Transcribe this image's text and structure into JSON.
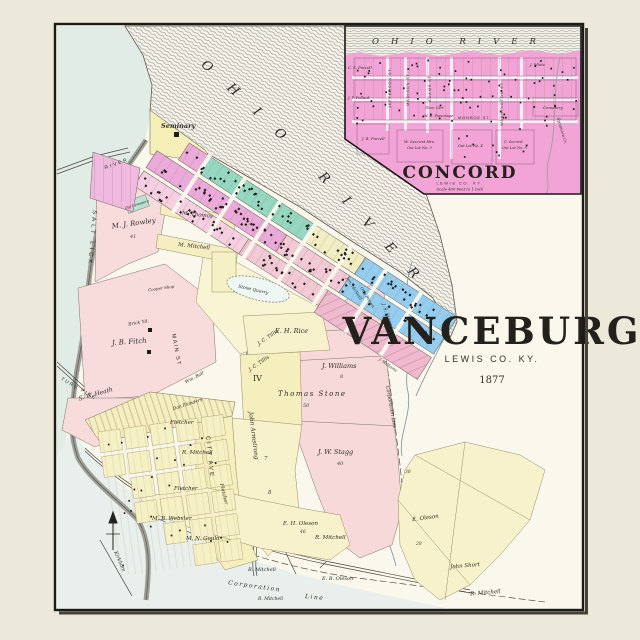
{
  "map": {
    "river_label": "OHIO RIVER",
    "title": "VANCEBURG",
    "subtitle": "LEWIS CO. KY.",
    "year": "1877",
    "labels": {
      "seminary": "Seminary",
      "rowley": "M. J. Rowley",
      "thomas": "M. Thomas",
      "mitchell_m": "M. Mitchell",
      "old_cemetery": "Old Cemetery",
      "fitch": "J. B. Fitch",
      "heath": "S. W. Heath",
      "rice": "E. H. Rice",
      "tillis1": "J. C. Tillis",
      "tillis2": "J. C. Tillis",
      "section_iv": "IV",
      "williams": "J. Williams",
      "williams_small": "J. Williams",
      "stone": "Thomas Stone",
      "stagg": "J. W. Stagg",
      "armstrong": "John Armstrong",
      "fletcher1": "Fletcher",
      "fletcher2": "Fletcher",
      "fletcher3": "Fletcher",
      "mitchell_r1": "R. Mitchell",
      "mitchell_r2": "R. Mitchell",
      "mitchell_r3": "R. Mitchell",
      "mitchell_r4": "R. Mitchell",
      "mitchell_r5": "R. Mitchell",
      "webster": "M. B. Webster",
      "gould": "M. N. Gould",
      "oleson_eh": "E. H. Oleson",
      "oleson_eb": "E. B. Oleson",
      "oleson_e": "E. Oleson",
      "short": "John Short",
      "corporation": "Corporation",
      "line": "Line",
      "corp_line_right": "Corporation Line",
      "salt_lick": "SALT LICK",
      "river_road": "RIVER",
      "turnpike": "TURN PIKE",
      "kirkham": "Kirkham",
      "city_ave": "CITY AVE",
      "main_st": "MAIN ST",
      "stone_quarry": "Stone Quarry",
      "brick_yard": "Brick Yd.",
      "cooper_shop": "Cooper Shop",
      "ball": "Wm. Ball",
      "flanders": "Dan Flanders",
      "mcneill": "Jno. McNeill",
      "brown": "Otis Brown",
      "stagg_js": "J. S. Stagg"
    },
    "numbers": {
      "n41": "41",
      "n50": "50",
      "n40": "40",
      "n8": "8",
      "n7": "7",
      "n8b": "8",
      "n46": "46",
      "n38": "38",
      "n28": "28"
    }
  },
  "inset": {
    "river_label": "OHIO RIVER",
    "title": "CONCORD",
    "subtitle": "LEWIS CO. KY.",
    "scale": "Scale 400 Feet to 1 Inch",
    "streets": {
      "jefferson": "JEFFERSON ST.",
      "madison": "MADISON ST.",
      "adams": "ADAMS ST.",
      "washington": "WASHINGTON ST.",
      "monroe": "MONROE ST."
    },
    "labels": {
      "purcell_cs": "C. S. Purcell",
      "pollock": "J. P. Pollock",
      "purcell_jr": "J. R. Purcell",
      "secrest_w": "W. Secrest Hrs.",
      "outlot3": "Out Lot No. 3",
      "carr": "Thos. Carr",
      "parsonage": "M. E. Parsonage",
      "white": "J. White",
      "cemetery": "Cemetery",
      "outlot4": "Out Lot No. 4",
      "secrest_c": "C. Secrest",
      "outlot5": "Out Lot No. 5",
      "sycamore": "Sycamore Cr."
    }
  },
  "colors": {
    "paper": "#faf7ec",
    "margin": "#ece9db",
    "inset_pink": "#f2a4d6",
    "magenta": "#ebaada",
    "teal": "#95d8c1",
    "blue": "#93cdef",
    "yellow_block": "#f4eec0",
    "yellow_lot": "#f7f2cb",
    "lot_pink": "#f7d9d9",
    "water": "#e1ece7"
  }
}
